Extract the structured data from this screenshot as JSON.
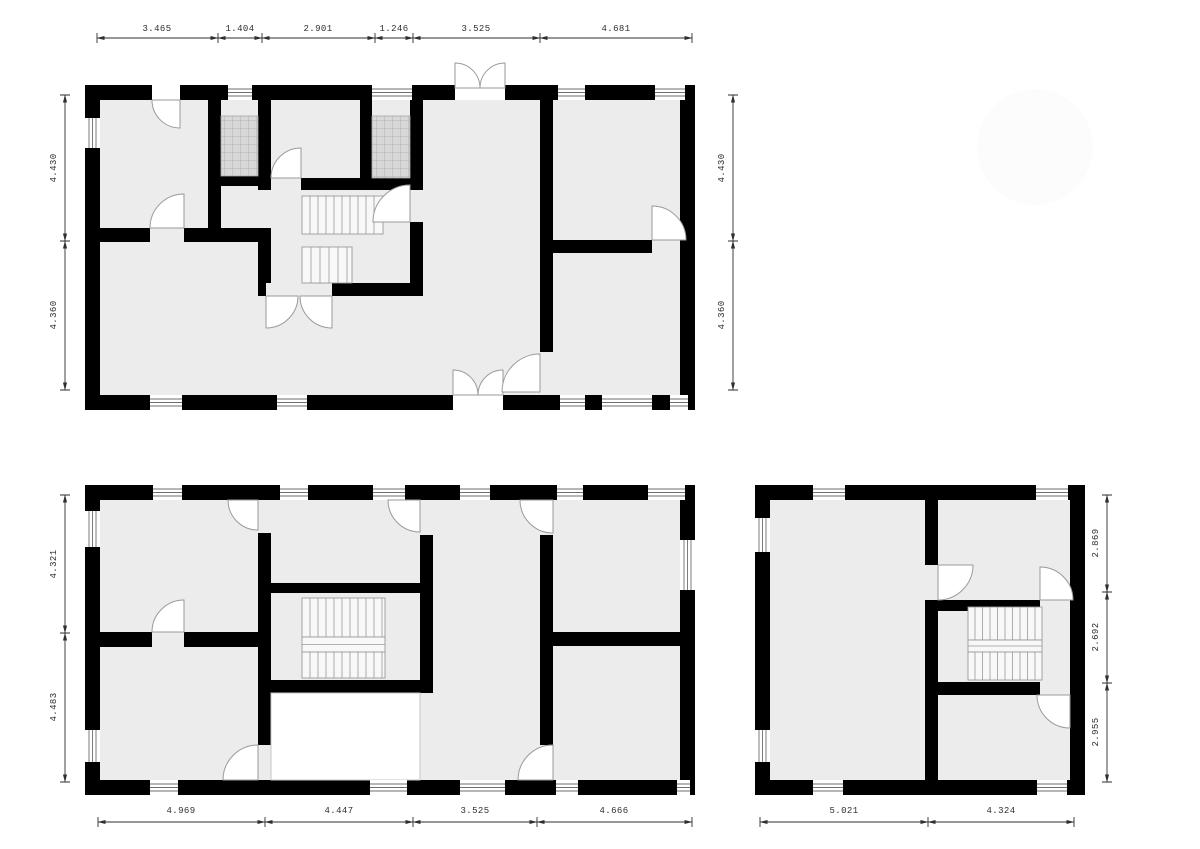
{
  "drawing": {
    "type": "architectural floor plans",
    "background": "#ffffff",
    "wall_color": "#000000",
    "room_fill": "#ececec",
    "hatch_fill": "#d8d8d8",
    "door_arc_color": "#9a9a9a",
    "dimension_color": "#2e2e2e"
  },
  "plans": [
    {
      "id": "floor-plan-1",
      "dims": {
        "top": [
          "3.465",
          "1.404",
          "2.901",
          "1.246",
          "3.525",
          "4.681"
        ],
        "left": [
          "4.430",
          "4.360"
        ],
        "right": [
          "4.430",
          "4.360"
        ]
      }
    },
    {
      "id": "floor-plan-2",
      "dims": {
        "left": [
          "4.321",
          "4.483"
        ],
        "bottom": [
          "4.969",
          "4.447",
          "3.525",
          "4.666"
        ]
      }
    },
    {
      "id": "floor-plan-3",
      "dims": {
        "right": [
          "2.869",
          "2.692",
          "2.955"
        ],
        "bottom": [
          "5.021",
          "4.324"
        ]
      }
    }
  ]
}
